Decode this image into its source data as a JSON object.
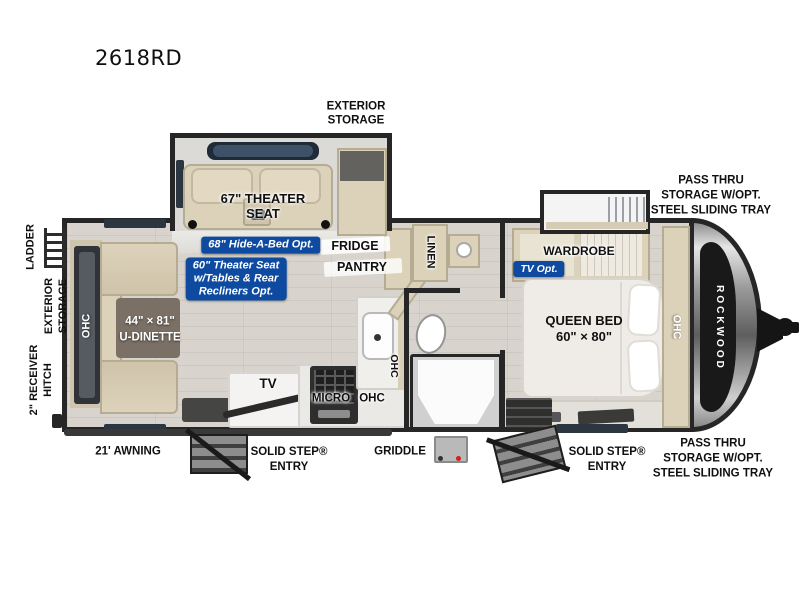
{
  "title": "2618RD",
  "colors": {
    "badge_blue": "#0d4aa0",
    "wall_dark": "#262626",
    "floor": "#d6d2cb",
    "cabinet_tan": "#dcd1b9",
    "table_brown": "#7b7066"
  },
  "exterior": {
    "storage_top": [
      "EXTERIOR",
      "STORAGE"
    ],
    "pass_thru": [
      "PASS THRU",
      "STORAGE W/OPT.",
      "STEEL SLIDING TRAY"
    ],
    "ladder": "LADDER",
    "storage_left": [
      "EXTERIOR",
      "STORAGE"
    ],
    "receiver_hitch": [
      "2\" RECEIVER",
      "HITCH"
    ],
    "awning": "21' AWNING",
    "solid_step": [
      "SOLID STEP®",
      "ENTRY"
    ],
    "griddle": "GRIDDLE",
    "brand": "ROCKWOOD"
  },
  "interior": {
    "theater_seat": [
      "67\" THEATER",
      "SEAT"
    ],
    "hide_a_bed": "68\" Hide-A-Bed Opt.",
    "theater_opt": [
      "60\" Theater Seat",
      "w/Tables & Rear",
      "Recliners Opt."
    ],
    "fridge": "FRIDGE",
    "pantry": "PANTRY",
    "linen": "LINEN",
    "wardrobe": "WARDROBE",
    "tv_opt": "TV Opt.",
    "queen_bed": [
      "QUEEN BED",
      "60\" × 80\""
    ],
    "u_dinette": [
      "44\" × 81\"",
      "U-DINETTE"
    ],
    "tv": "TV",
    "micro": "MICRO",
    "ohc": "OHC"
  }
}
